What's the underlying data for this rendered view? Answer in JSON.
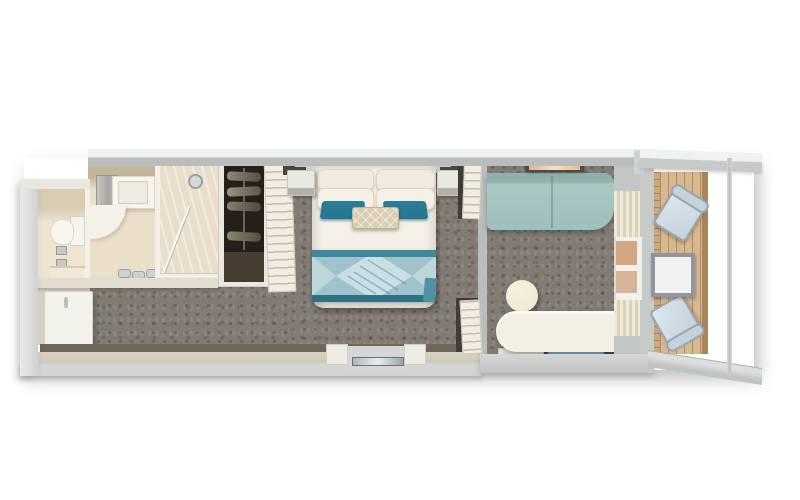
{
  "scene": {
    "type": "floor-plan",
    "render_style": "top-down 3D cutaway render",
    "subject": "Cruise-ship balcony stateroom floor plan",
    "background": "#ffffff",
    "text_labels": []
  },
  "rooms": [
    {
      "name": "bathroom",
      "zones": [
        "toilet room",
        "vanity room",
        "shower room"
      ],
      "furniture": [
        "toilet",
        "wall fixtures",
        "shelf",
        "mirror cabinet",
        "vanity sink unit",
        "curved counter",
        "faucet set",
        "glass shower door",
        "shower head"
      ]
    },
    {
      "name": "entry-hall",
      "furniture": [
        "entry door leaf",
        "door handle",
        "wardrobe with five hangers",
        "wardrobe floor",
        "open shelf unit"
      ]
    },
    {
      "name": "bedroom",
      "furniture": [
        "headboard",
        "queen bed",
        "four white pillows",
        "two teal accent pillows",
        "patterned lumbar pillow",
        "diamond-pattern bed runner",
        "left nightstand",
        "right nightstand",
        "wall sconces",
        "entry alcove with threshold",
        "teal foot throw"
      ]
    },
    {
      "name": "sitting-area",
      "furniture": [
        "seafoam sofa",
        "ceiling light fixture",
        "round ottoman",
        "curved desk",
        "media shelf with blue glow",
        "curtained glass door"
      ]
    },
    {
      "name": "balcony",
      "furniture": [
        "wood plank deck",
        "upper deck chair",
        "lower deck chair",
        "square table",
        "railing",
        "upper privacy divider",
        "lower privacy divider"
      ]
    }
  ],
  "colors": {
    "wall_top": "#eff1f0",
    "wall_face": "#b9bdbb",
    "wall_outer": "#ced2d0",
    "carpet": "#827b73",
    "bath_floor": "#eee4d1",
    "bath_wall": "#f2f0e9",
    "marble": "#e8decb",
    "duvet": "#f4f0e7",
    "pillow": "#f0ebdf",
    "teal_pillow": "#217691",
    "runner_base": "#9fc2cc",
    "runner_light": "#cadfe4",
    "runner_edge": "#3f879c",
    "sofa": "#9fbfbb",
    "ottoman": "#eee6d4",
    "desk": "#f3efe5",
    "wood_deck": "#d9b88f",
    "chair_seat": "#c3d2dc",
    "chair_frame": "#9aa5ad",
    "wardrobe_dark": "#251f19",
    "wardrobe_floor": "#463c30",
    "door": "#f2f1ea",
    "bottom_wall": "#cfc8b6",
    "dark_floor_strip": "#6f675c",
    "glow_blue": "#4f94c4",
    "light_amber": "#e9bd8d"
  }
}
